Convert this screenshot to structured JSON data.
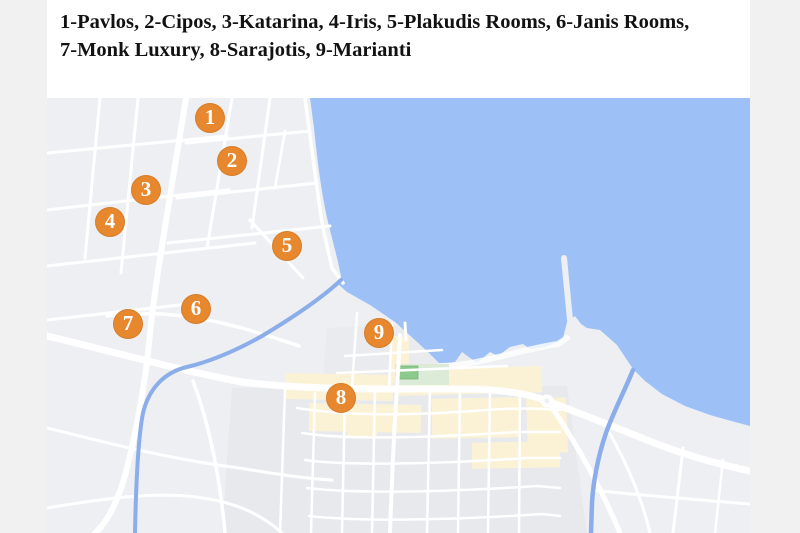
{
  "legend": {
    "line1": "1-Pavlos, 2-Cipos, 3-Katarina, 4-Iris, 5-Plakudis Rooms, 6-Janis Rooms,",
    "line2": "7-Monk Luxury, 8-Sarajotis, 9-Marianti"
  },
  "hotels": [
    {
      "number": "1",
      "name": "Pavlos",
      "x": 210,
      "y": 118
    },
    {
      "number": "2",
      "name": "Cipos",
      "x": 232,
      "y": 161
    },
    {
      "number": "3",
      "name": "Katarina",
      "x": 146,
      "y": 190
    },
    {
      "number": "4",
      "name": "Iris",
      "x": 110,
      "y": 222
    },
    {
      "number": "5",
      "name": "Plakudis Rooms",
      "x": 287,
      "y": 246
    },
    {
      "number": "6",
      "name": "Janis Rooms",
      "x": 196,
      "y": 309
    },
    {
      "number": "7",
      "name": "Monk Luxury",
      "x": 128,
      "y": 324
    },
    {
      "number": "8",
      "name": "Sarajotis",
      "x": 341,
      "y": 398
    },
    {
      "number": "9",
      "name": "Marianti",
      "x": 379,
      "y": 333
    }
  ],
  "map": {
    "colors": {
      "land": "#edeff2",
      "town_blocks": "#e6e8ec",
      "water": "#9dc1f7",
      "road": "#ffffff",
      "stream": "#8badea",
      "commercial": "#fbf2d6",
      "park": "#8cc98c",
      "park_light": "#dcebd8",
      "marker": "#e7872e",
      "marker_text": "#ffffff"
    }
  }
}
